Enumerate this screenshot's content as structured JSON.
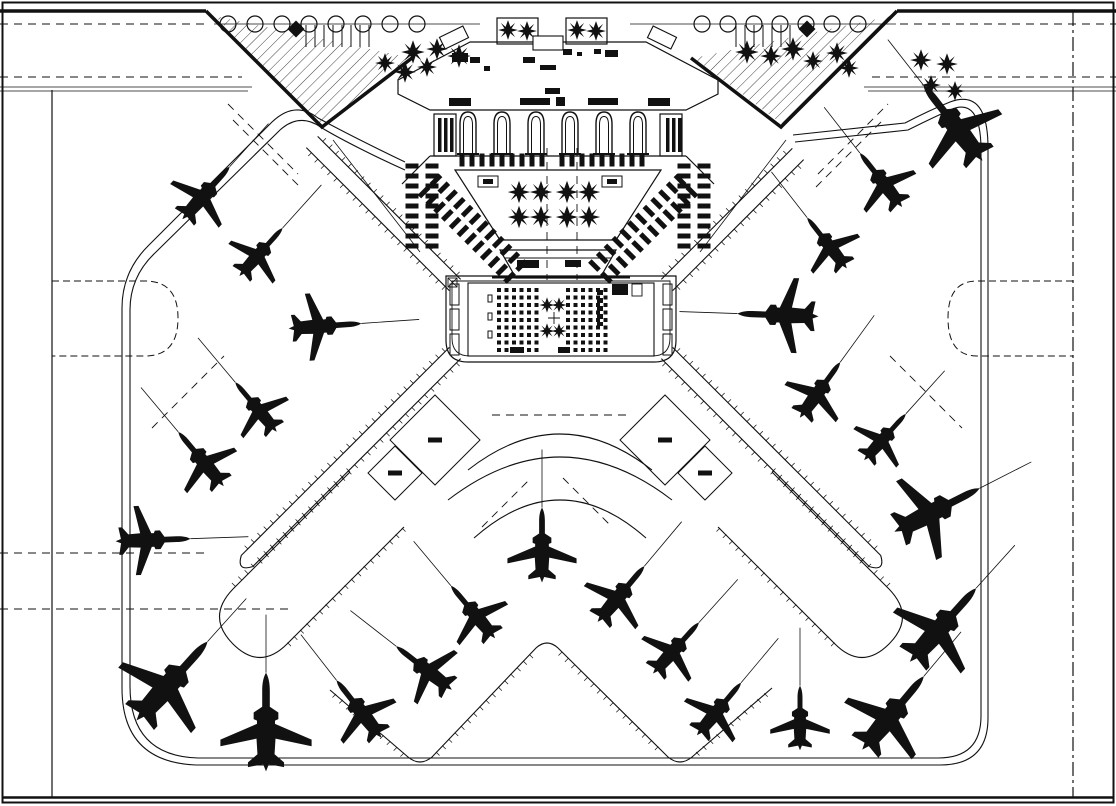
{
  "drawing": {
    "kind": "airport-terminal-site-plan",
    "palette": {
      "ink": "#111111",
      "paper": "#ffffff"
    },
    "canvas": {
      "w": 1116,
      "h": 806
    },
    "aircraft": [
      {
        "x": 206,
        "y": 193,
        "rot": 42,
        "s": 0.68
      },
      {
        "x": 261,
        "y": 252,
        "rot": 42,
        "s": 0.62
      },
      {
        "x": 325,
        "y": 326,
        "rot": 86,
        "s": 0.7
      },
      {
        "x": 256,
        "y": 407,
        "rot": -40,
        "s": 0.62
      },
      {
        "x": 201,
        "y": 459,
        "rot": -40,
        "s": 0.68
      },
      {
        "x": 153,
        "y": 540,
        "rot": 88,
        "s": 0.72
      },
      {
        "x": 172,
        "y": 681,
        "rot": 42,
        "s": 1.02
      },
      {
        "x": 266,
        "y": 722,
        "rot": 0,
        "s": 0.95
      },
      {
        "x": 359,
        "y": 709,
        "rot": -38,
        "s": 0.7
      },
      {
        "x": 424,
        "y": 668,
        "rot": -52,
        "s": 0.68
      },
      {
        "x": 473,
        "y": 612,
        "rot": -40,
        "s": 0.66
      },
      {
        "x": 542,
        "y": 545,
        "rot": 0,
        "s": 0.72
      },
      {
        "x": 621,
        "y": 594,
        "rot": 40,
        "s": 0.7
      },
      {
        "x": 676,
        "y": 648,
        "rot": 42,
        "s": 0.66
      },
      {
        "x": 719,
        "y": 709,
        "rot": 40,
        "s": 0.66
      },
      {
        "x": 800,
        "y": 718,
        "rot": 0,
        "s": 0.62
      },
      {
        "x": 893,
        "y": 713,
        "rot": 40,
        "s": 0.92
      },
      {
        "x": 943,
        "y": 625,
        "rot": 42,
        "s": 0.95
      },
      {
        "x": 937,
        "y": 510,
        "rot": 63,
        "s": 0.92
      },
      {
        "x": 885,
        "y": 437,
        "rot": 42,
        "s": 0.6
      },
      {
        "x": 820,
        "y": 390,
        "rot": 36,
        "s": 0.66
      },
      {
        "x": 778,
        "y": 315,
        "rot": -88,
        "s": 0.78
      },
      {
        "x": 827,
        "y": 243,
        "rot": -38,
        "s": 0.62
      },
      {
        "x": 881,
        "y": 180,
        "rot": -38,
        "s": 0.66
      },
      {
        "x": 953,
        "y": 123,
        "rot": -38,
        "s": 0.92
      }
    ],
    "lead_line_length": 58,
    "piers": [
      {
        "x1": 455,
        "y1": 285,
        "x2": 312,
        "y2": 142,
        "cap": false
      },
      {
        "x1": 667,
        "y1": 285,
        "x2": 798,
        "y2": 154,
        "cap": false
      },
      {
        "x1": 455,
        "y1": 353,
        "x2": 247,
        "y2": 561,
        "cap": true
      },
      {
        "x1": 667,
        "y1": 353,
        "x2": 875,
        "y2": 561,
        "cap": true
      }
    ],
    "pier_halfwidth": 8,
    "stand_pads": [
      {
        "cx": 435,
        "cy": 440,
        "r": 45
      },
      {
        "cx": 395,
        "cy": 473,
        "r": 27
      },
      {
        "cx": 665,
        "cy": 440,
        "r": 45
      },
      {
        "cx": 705,
        "cy": 473,
        "r": 27
      }
    ],
    "arches": {
      "centers": [
        468,
        502,
        536,
        570,
        604,
        638
      ],
      "top_y": 114
    },
    "planters": [
      {
        "x": 497,
        "y": 18,
        "w": 41,
        "h": 26
      },
      {
        "x": 566,
        "y": 18,
        "w": 41,
        "h": 26
      }
    ],
    "kiosks": [
      {
        "x": 478,
        "y": 176,
        "w": 20,
        "h": 11
      },
      {
        "x": 602,
        "y": 176,
        "w": 20,
        "h": 11
      }
    ],
    "trees_star": [
      {
        "x": 413,
        "y": 52,
        "s": 1.3
      },
      {
        "x": 437,
        "y": 49,
        "s": 1.2
      },
      {
        "x": 459,
        "y": 56,
        "s": 1.3
      },
      {
        "x": 427,
        "y": 67,
        "s": 1.1
      },
      {
        "x": 405,
        "y": 72,
        "s": 1.2
      },
      {
        "x": 385,
        "y": 63,
        "s": 1.1
      },
      {
        "x": 747,
        "y": 52,
        "s": 1.3
      },
      {
        "x": 771,
        "y": 56,
        "s": 1.2
      },
      {
        "x": 793,
        "y": 49,
        "s": 1.3
      },
      {
        "x": 813,
        "y": 61,
        "s": 1.1
      },
      {
        "x": 837,
        "y": 53,
        "s": 1.2
      },
      {
        "x": 849,
        "y": 68,
        "s": 1.1
      },
      {
        "x": 921,
        "y": 60,
        "s": 1.2
      },
      {
        "x": 947,
        "y": 64,
        "s": 1.2
      },
      {
        "x": 931,
        "y": 85,
        "s": 1.1
      },
      {
        "x": 955,
        "y": 91,
        "s": 1.1
      },
      {
        "x": 508,
        "y": 30,
        "s": 1.1
      },
      {
        "x": 527,
        "y": 31,
        "s": 1.1
      },
      {
        "x": 577,
        "y": 30,
        "s": 1.1
      },
      {
        "x": 596,
        "y": 31,
        "s": 1.1
      },
      {
        "x": 519,
        "y": 192,
        "s": 1.25
      },
      {
        "x": 541,
        "y": 192,
        "s": 1.25
      },
      {
        "x": 567,
        "y": 192,
        "s": 1.25
      },
      {
        "x": 589,
        "y": 192,
        "s": 1.25
      },
      {
        "x": 519,
        "y": 217,
        "s": 1.25
      },
      {
        "x": 541,
        "y": 217,
        "s": 1.25
      },
      {
        "x": 567,
        "y": 217,
        "s": 1.25
      },
      {
        "x": 589,
        "y": 217,
        "s": 1.25
      },
      {
        "x": 547,
        "y": 305,
        "s": 0.85
      },
      {
        "x": 559,
        "y": 305,
        "s": 0.85
      },
      {
        "x": 547,
        "y": 331,
        "s": 0.85
      },
      {
        "x": 559,
        "y": 331,
        "s": 0.85
      }
    ],
    "tree_rows_round": [
      {
        "y": 24,
        "x1": 228,
        "x2": 418,
        "step": 27,
        "r": 8
      },
      {
        "y": 24,
        "x1": 702,
        "x2": 880,
        "step": 26,
        "r": 8
      }
    ],
    "stem_combs": [
      {
        "x1": 306,
        "x2": 369,
        "step": 9,
        "y1": 25,
        "y2": 47
      },
      {
        "x1": 736,
        "x2": 790,
        "step": 9,
        "y1": 25,
        "y2": 47
      }
    ],
    "shrub_diamonds": [
      {
        "x": 296,
        "y": 29
      },
      {
        "x": 807,
        "y": 29
      }
    ],
    "seat_blocks": [
      {
        "x": 497,
        "y": 288,
        "cols": 6,
        "rows": 9,
        "cell": 4,
        "gap": 3.5
      },
      {
        "x": 566,
        "y": 288,
        "cols": 6,
        "rows": 9,
        "cell": 4,
        "gap": 3.5
      }
    ],
    "gate_slabs": [
      {
        "x": 450,
        "y": 284,
        "w": 9,
        "h": 21
      },
      {
        "x": 450,
        "y": 309,
        "w": 9,
        "h": 21
      },
      {
        "x": 450,
        "y": 334,
        "w": 9,
        "h": 21
      },
      {
        "x": 663,
        "y": 284,
        "w": 9,
        "h": 21
      },
      {
        "x": 663,
        "y": 309,
        "w": 9,
        "h": 21
      },
      {
        "x": 663,
        "y": 334,
        "w": 9,
        "h": 21
      },
      {
        "x": 488,
        "y": 295,
        "w": 4,
        "h": 7
      },
      {
        "x": 488,
        "y": 313,
        "w": 4,
        "h": 7
      },
      {
        "x": 488,
        "y": 331,
        "w": 4,
        "h": 7
      }
    ],
    "furniture": [
      {
        "x": 452,
        "y": 53,
        "w": 16,
        "h": 9
      },
      {
        "x": 470,
        "y": 57,
        "w": 10,
        "h": 6
      },
      {
        "x": 484,
        "y": 66,
        "w": 6,
        "h": 5
      },
      {
        "x": 523,
        "y": 57,
        "w": 12,
        "h": 6
      },
      {
        "x": 540,
        "y": 65,
        "w": 16,
        "h": 5
      },
      {
        "x": 563,
        "y": 49,
        "w": 9,
        "h": 6
      },
      {
        "x": 577,
        "y": 52,
        "w": 5,
        "h": 4
      },
      {
        "x": 594,
        "y": 49,
        "w": 7,
        "h": 5
      },
      {
        "x": 605,
        "y": 50,
        "w": 13,
        "h": 7
      },
      {
        "x": 545,
        "y": 88,
        "w": 15,
        "h": 6
      },
      {
        "x": 449,
        "y": 98,
        "w": 22,
        "h": 8
      },
      {
        "x": 520,
        "y": 98,
        "w": 30,
        "h": 7
      },
      {
        "x": 556,
        "y": 97,
        "w": 9,
        "h": 9
      },
      {
        "x": 588,
        "y": 98,
        "w": 30,
        "h": 7
      },
      {
        "x": 648,
        "y": 98,
        "w": 22,
        "h": 8
      },
      {
        "x": 517,
        "y": 260,
        "w": 22,
        "h": 8
      },
      {
        "x": 565,
        "y": 260,
        "w": 16,
        "h": 7
      },
      {
        "x": 612,
        "y": 284,
        "w": 16,
        "h": 11
      },
      {
        "x": 510,
        "y": 347,
        "w": 14,
        "h": 6
      },
      {
        "x": 558,
        "y": 347,
        "w": 12,
        "h": 6
      },
      {
        "x": 483,
        "y": 179,
        "w": 10,
        "h": 5
      },
      {
        "x": 607,
        "y": 179,
        "w": 10,
        "h": 5
      }
    ],
    "canopies": [
      {
        "x": 533,
        "y": 36,
        "w": 30,
        "h": 14,
        "rot": 0
      },
      {
        "x": 441,
        "y": 31,
        "w": 26,
        "h": 13,
        "rot": -26
      },
      {
        "x": 649,
        "y": 31,
        "w": 26,
        "h": 13,
        "rot": 26
      }
    ],
    "car_dash_rows": [
      {
        "x1": 412,
        "y1": 166,
        "x2": 412,
        "y2": 246,
        "step": 10
      },
      {
        "x1": 432,
        "y1": 166,
        "x2": 432,
        "y2": 246,
        "step": 10
      },
      {
        "x1": 684,
        "y1": 166,
        "x2": 684,
        "y2": 246,
        "step": 10
      },
      {
        "x1": 704,
        "y1": 166,
        "x2": 704,
        "y2": 246,
        "step": 10
      },
      {
        "x1": 424,
        "y1": 192,
        "x2": 514,
        "y2": 282,
        "step": 11
      },
      {
        "x1": 436,
        "y1": 180,
        "x2": 526,
        "y2": 270,
        "step": 11
      },
      {
        "x1": 692,
        "y1": 192,
        "x2": 602,
        "y2": 282,
        "step": 11
      },
      {
        "x1": 680,
        "y1": 180,
        "x2": 590,
        "y2": 270,
        "step": 11
      },
      {
        "x1": 462,
        "y1": 160,
        "x2": 544,
        "y2": 160,
        "step": 10
      },
      {
        "x1": 562,
        "y1": 160,
        "x2": 644,
        "y2": 160,
        "step": 10
      }
    ],
    "dash_lines": [
      {
        "x1": 0,
        "y1": 24,
        "x2": 208,
        "y2": 24
      },
      {
        "x1": 900,
        "y1": 24,
        "x2": 1116,
        "y2": 24
      },
      {
        "x1": 0,
        "y1": 77,
        "x2": 242,
        "y2": 77
      },
      {
        "x1": 872,
        "y1": 77,
        "x2": 1116,
        "y2": 77
      },
      {
        "x1": 0,
        "y1": 553,
        "x2": 205,
        "y2": 553
      },
      {
        "x1": 0,
        "y1": 609,
        "x2": 290,
        "y2": 609
      },
      {
        "x1": 228,
        "y1": 104,
        "x2": 298,
        "y2": 174
      },
      {
        "x1": 818,
        "y1": 174,
        "x2": 888,
        "y2": 104
      },
      {
        "x1": 233,
        "y1": 120,
        "x2": 300,
        "y2": 187
      },
      {
        "x1": 816,
        "y1": 187,
        "x2": 883,
        "y2": 120
      },
      {
        "x1": 152,
        "y1": 428,
        "x2": 224,
        "y2": 356
      },
      {
        "x1": 890,
        "y1": 356,
        "x2": 962,
        "y2": 428
      },
      {
        "x1": 563,
        "y1": 478,
        "x2": 612,
        "y2": 527
      },
      {
        "x1": 482,
        "y1": 527,
        "x2": 531,
        "y2": 478
      },
      {
        "x1": 492,
        "y1": 415,
        "x2": 630,
        "y2": 415
      },
      {
        "x1": 547,
        "y1": 148,
        "x2": 547,
        "y2": 280
      },
      {
        "x1": 577,
        "y1": 148,
        "x2": 577,
        "y2": 280
      }
    ],
    "thin_lines": [
      {
        "x1": 214,
        "y1": 24,
        "x2": 480,
        "y2": 24
      },
      {
        "x1": 630,
        "y1": 24,
        "x2": 896,
        "y2": 24
      },
      {
        "x1": 0,
        "y1": 87,
        "x2": 252,
        "y2": 87
      },
      {
        "x1": 0,
        "y1": 91,
        "x2": 248,
        "y2": 91
      },
      {
        "x1": 864,
        "y1": 87,
        "x2": 1116,
        "y2": 87
      },
      {
        "x1": 868,
        "y1": 91,
        "x2": 1116,
        "y2": 91
      },
      {
        "x1": 333,
        "y1": 140,
        "x2": 420,
        "y2": 252
      },
      {
        "x1": 786,
        "y1": 140,
        "x2": 700,
        "y2": 252
      }
    ],
    "tick_strips": [
      {
        "x1": 436,
        "y1": 752,
        "x2": 532,
        "y2": 652,
        "nx": 0.7,
        "ny": 0.7,
        "step": 9,
        "len": 5
      },
      {
        "x1": 562,
        "y1": 652,
        "x2": 664,
        "y2": 752,
        "nx": -0.7,
        "ny": 0.7,
        "step": 9,
        "len": 5
      },
      {
        "x1": 336,
        "y1": 694,
        "x2": 404,
        "y2": 753,
        "nx": -0.7,
        "ny": 0.7,
        "step": 9,
        "len": 5
      },
      {
        "x1": 696,
        "y1": 752,
        "x2": 768,
        "y2": 690,
        "nx": 0.7,
        "ny": 0.7,
        "step": 9,
        "len": 5
      },
      {
        "x1": 350,
        "y1": 472,
        "x2": 235,
        "y2": 587,
        "nx": -0.7,
        "ny": -0.7,
        "step": 9,
        "len": 5
      },
      {
        "x1": 402,
        "y1": 528,
        "x2": 287,
        "y2": 643,
        "nx": 0.7,
        "ny": 0.7,
        "step": 9,
        "len": 5
      },
      {
        "x1": 772,
        "y1": 472,
        "x2": 887,
        "y2": 587,
        "nx": 0.7,
        "ny": -0.7,
        "step": 9,
        "len": 5
      },
      {
        "x1": 720,
        "y1": 528,
        "x2": 835,
        "y2": 643,
        "nx": -0.7,
        "ny": 0.7,
        "step": 9,
        "len": 5
      }
    ]
  }
}
